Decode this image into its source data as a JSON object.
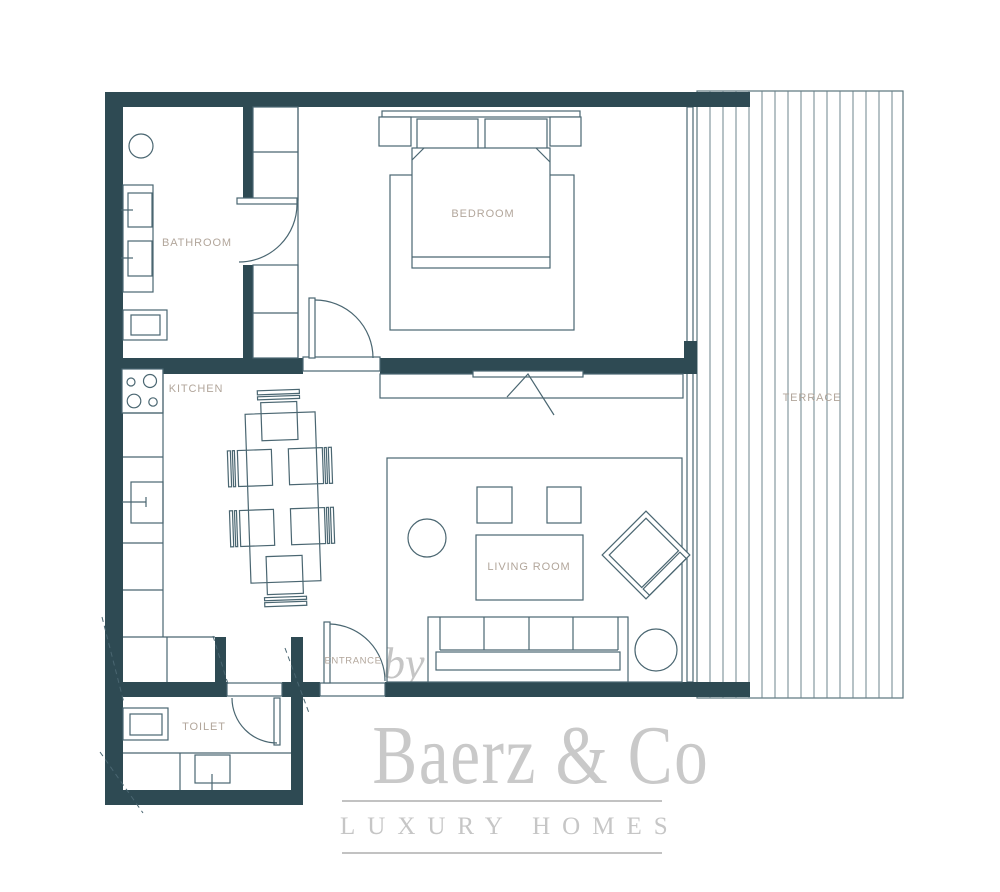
{
  "title": "Apartment floor plan",
  "labels": {
    "bathroom": "BATHROOM",
    "bedroom": "BEDROOM",
    "kitchen": "KITCHEN",
    "living_room": "LIVING ROOM",
    "entrance": "ENTRANCE",
    "toilet": "TOILET",
    "terrace": "TERRACE"
  },
  "branding": {
    "prefix": "by",
    "name": "Baerz & Co",
    "tagline": "LUXURY HOMES"
  },
  "colors": {
    "wall": "#2e4a53",
    "line": "#4a6671",
    "plank_line": "#6d858d",
    "label_text": "#b2a69b",
    "watermark": "#c9c9c9"
  }
}
